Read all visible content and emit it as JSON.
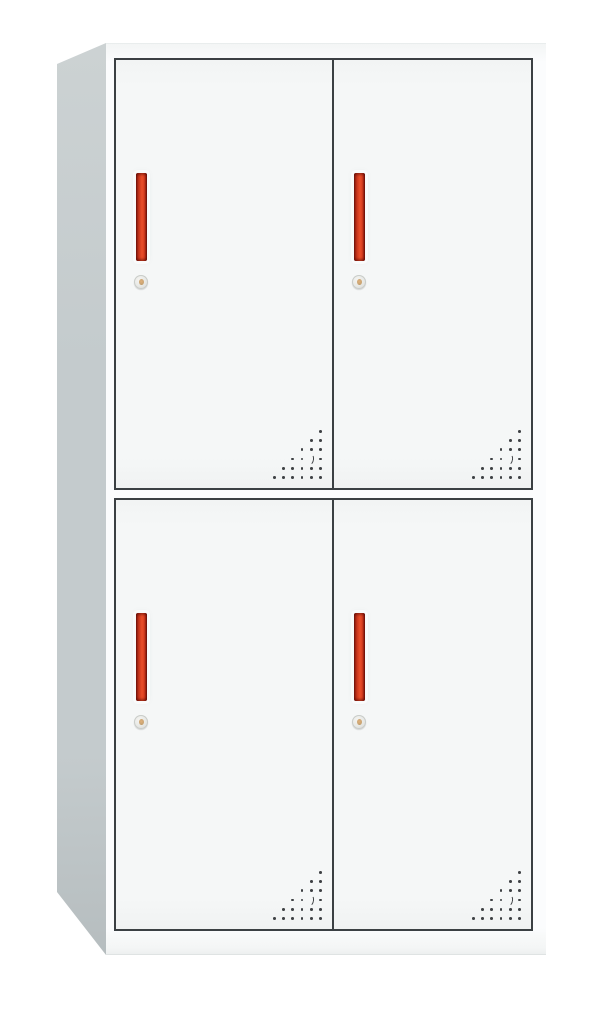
{
  "scene": {
    "type": "product-photo",
    "subject": "Two-tier four-door steel locker cabinet with red handles",
    "view": "front three-quarter view, left side panel visible",
    "background": "#ffffff"
  },
  "colors": {
    "side_panel": "#c4cbcd",
    "side_panel_dark": "#b6bdbf",
    "side_panel_light": "#ccd2d3",
    "front_face": "#fbfcfd",
    "door_fill": "#f5f7f7",
    "door_outline": "#3b4043",
    "handle_dark": "#801a0e",
    "handle_mid": "#d03a1e",
    "handle_bright": "#e94f2a",
    "lock_body": "#e9eae7",
    "lock_ring": "#c9ccc9",
    "lock_center": "#c7a372",
    "vent_dot": "#3e4144",
    "top_edge": "#e9eded",
    "plinth_edge": "#dfe3e3"
  },
  "cabinet": {
    "tiers": 2,
    "columns": 2,
    "door_count": 4,
    "doors": [
      {
        "id": "top-left"
      },
      {
        "id": "top-right"
      },
      {
        "id": "bottom-left"
      },
      {
        "id": "bottom-right"
      }
    ],
    "door_hardware": [
      "vertical-red-handle",
      "cylinder-keyhole-lock",
      "corner-vent-perforations"
    ]
  },
  "vent_pattern": {
    "rows": 6,
    "layout": "right-aligned-triangle",
    "dot_count": 20,
    "crescent": {
      "row_from_top": 4,
      "col_from_right": 2
    },
    "spacing_x": 9.3,
    "spacing_y": 9.2,
    "dot_size": 2.8
  }
}
